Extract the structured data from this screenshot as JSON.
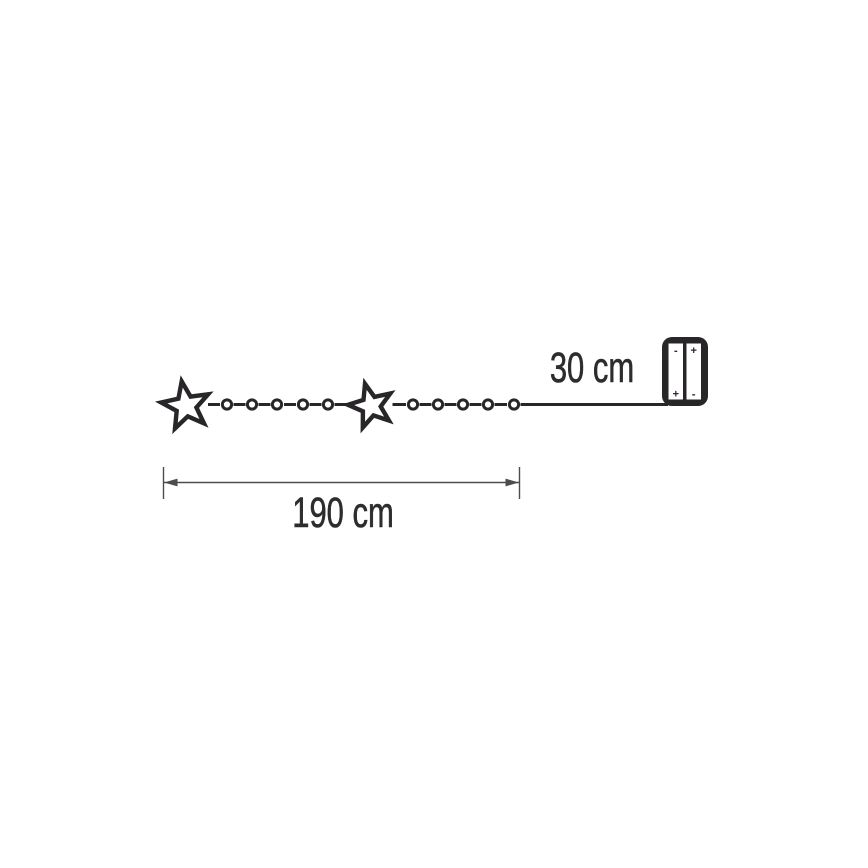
{
  "diagram": {
    "type": "string-lights-dimension-diagram",
    "labels": {
      "battery_lead_length": "30 cm",
      "lit_length": "190 cm"
    },
    "chain": {
      "star_count": 2,
      "bulb_count": 10
    },
    "battery_box": {
      "left_battery": {
        "top_sign": "-",
        "bottom_sign": "+"
      },
      "right_battery": {
        "top_sign": "+",
        "bottom_sign": "-"
      }
    },
    "colors": {
      "ink": "#29262a",
      "dimension_line": "#4c4c4e",
      "background": "#ffffff"
    }
  }
}
